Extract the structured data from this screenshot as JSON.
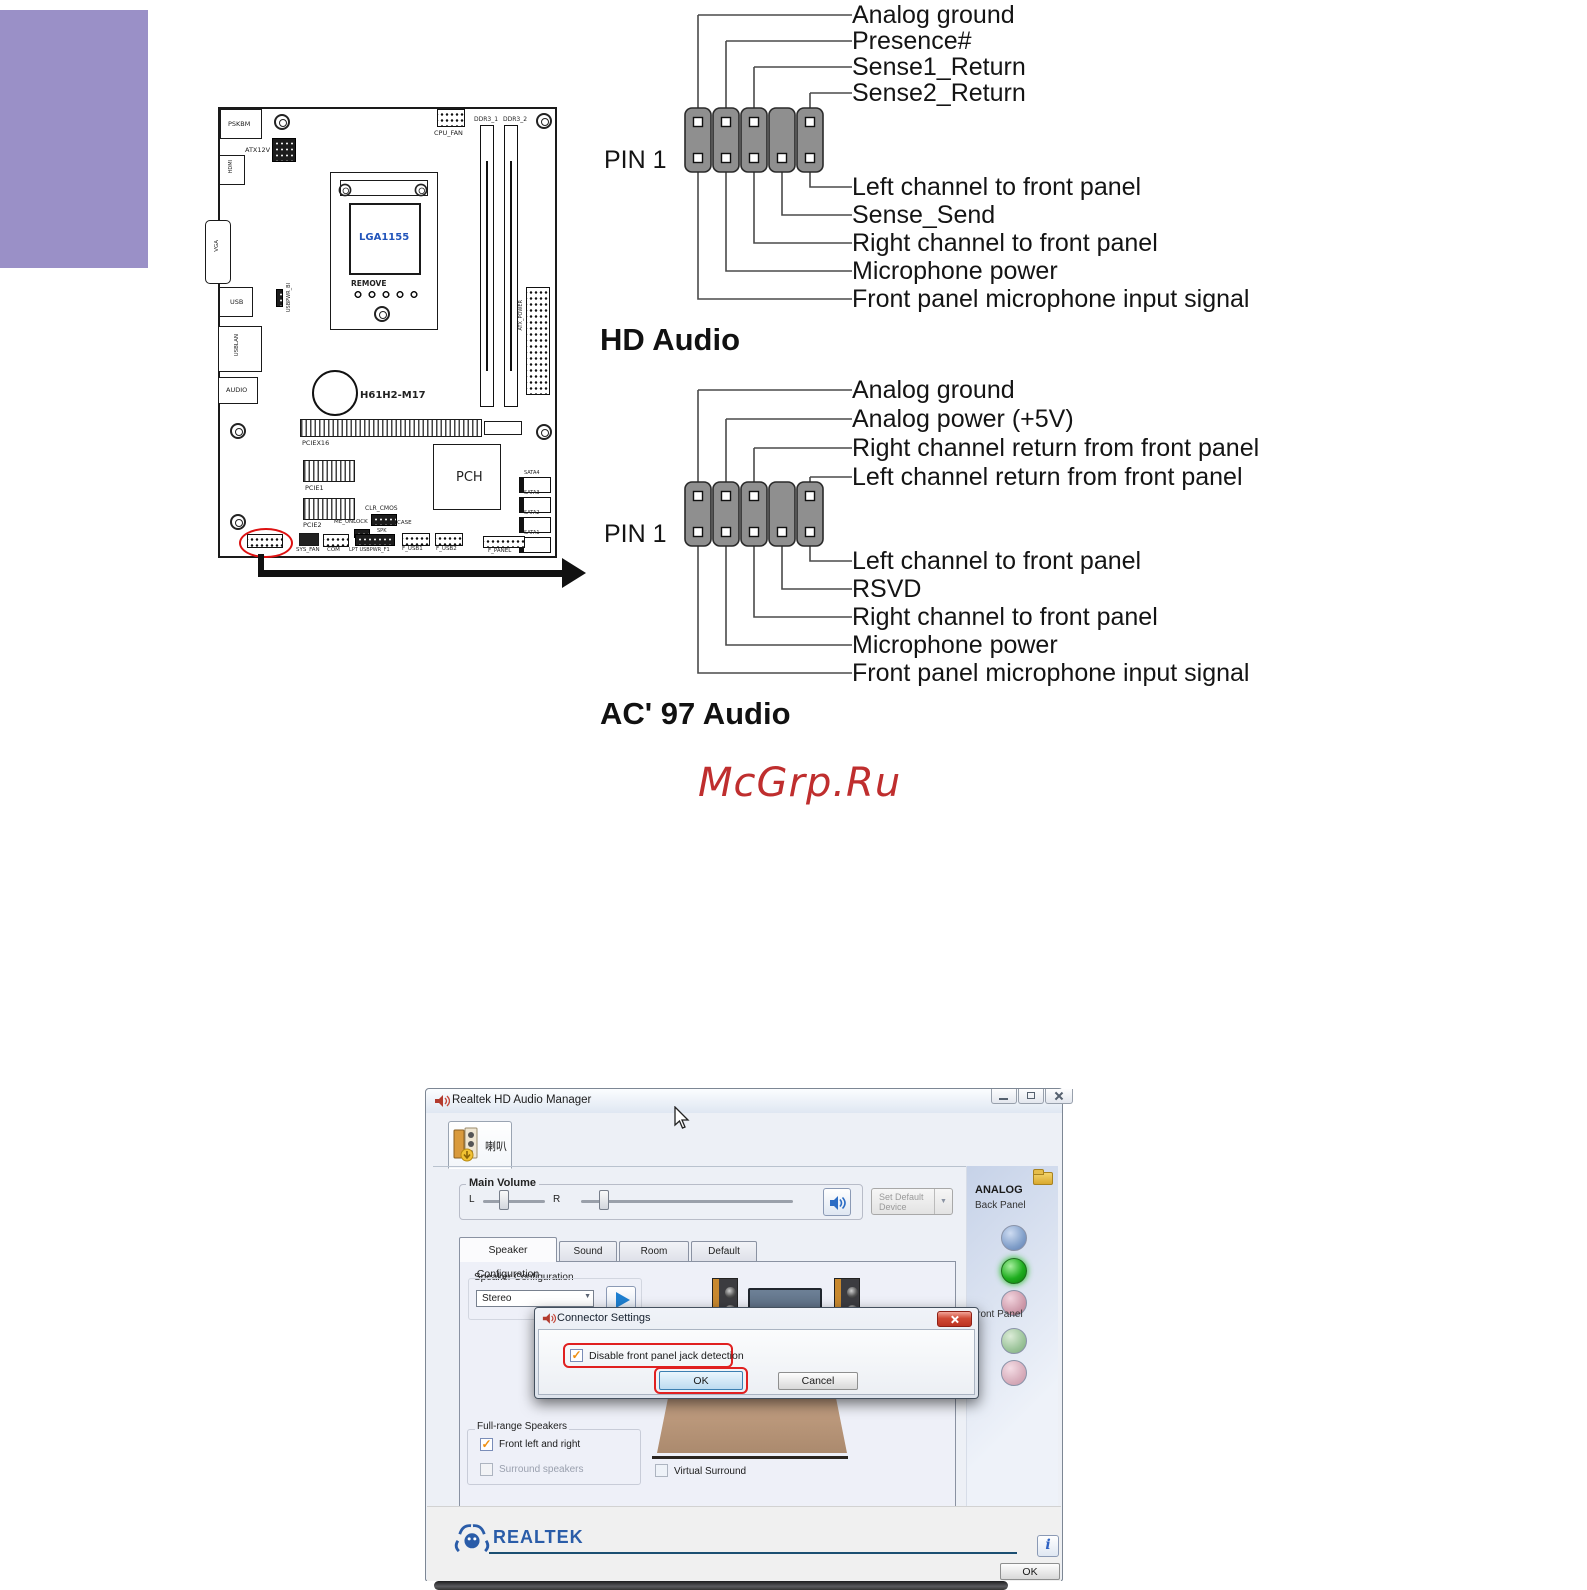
{
  "page": {
    "watermark": "McGrp.Ru"
  },
  "colors": {
    "purple_block": "#9a90c7",
    "red_highlight": "#dd1111",
    "watermark_red": "#bf2e2e",
    "realtek_blue": "#2a5ca8",
    "socket_label_blue": "#2255bb"
  },
  "icons": {
    "dropdown_arrow": "▼",
    "check": "✓",
    "info": "i"
  },
  "hd_audio": {
    "title": "HD Audio",
    "pin1_label": "PIN 1",
    "top_labels": [
      "Analog ground",
      "Presence#",
      "Sense1_Return",
      "Sense2_Return"
    ],
    "bottom_labels": [
      "Left channel to front panel",
      "Sense_Send",
      "Right channel to front panel",
      "Microphone power",
      "Front panel microphone input signal"
    ]
  },
  "ac97_audio": {
    "title": "AC' 97 Audio",
    "pin1_label": "PIN 1",
    "top_labels": [
      "Analog ground",
      "Analog power (+5V)",
      "Right channel return from front panel",
      "Left channel return from front panel"
    ],
    "bottom_labels": [
      "Left channel to front panel",
      "RSVD",
      "Right channel to front panel",
      "Microphone power",
      "Front panel microphone input signal"
    ]
  },
  "motherboard": {
    "model": "H61H2-M17",
    "socket": "LGA1155",
    "remove_label": "REMOVE",
    "labels": {
      "pskbm": "PSKBM",
      "atx12v": "ATX12V",
      "hdmi": "HDMI",
      "vga": "VGA",
      "usb": "USB",
      "usbpwr_bi": "USBPWR_BI",
      "usblan": "USBLAN",
      "audio": "AUDIO",
      "cpu_fan": "CPU_FAN",
      "ddr3_1": "DDR3_1",
      "ddr3_2": "DDR3_2",
      "atx_power": "ATX_POWER",
      "pciex16": "PCIEX16",
      "pcie1": "PCIE1",
      "pcie2": "PCIE2",
      "pch": "PCH",
      "sata4": "SATA4",
      "sata3": "SATA3",
      "sata2": "SATA2",
      "sata1": "SATA1",
      "clr_cmos": "CLR_CMOS",
      "me_unlock": "ME_UNLOCK",
      "case": "CASE",
      "spk": "SPK",
      "sys_fan": "SYS_FAN",
      "com": "COM",
      "lpt_usbpwr": "LPT USBPWR_F1",
      "f_usb1": "F_USB1",
      "f_usb2": "F_USB2",
      "f_panel": "F_PANEL"
    }
  },
  "realtek": {
    "window_title": "Realtek HD Audio Manager",
    "device_tab": "喇叭",
    "main_volume": {
      "label": "Main Volume",
      "left": "L",
      "right": "R"
    },
    "set_default_device": "Set Default Device",
    "tabs": [
      "Speaker Configuration",
      "Sound Effects",
      "Room Correction",
      "Default Format"
    ],
    "speaker_config": {
      "label": "Speaker Configuration",
      "value": "Stereo"
    },
    "full_range": {
      "label": "Full-range Speakers",
      "option1": "Front left and right",
      "option2": "Surround speakers"
    },
    "virtual_surround": "Virtual Surround",
    "right_panel": {
      "title": "ANALOG",
      "back": "Back Panel",
      "front": "Front Panel"
    },
    "brand": "REALTEK",
    "ok_label": "OK",
    "dialog": {
      "title": "Connector Settings",
      "checkbox": "Disable front panel jack detection",
      "ok": "OK",
      "cancel": "Cancel"
    }
  }
}
